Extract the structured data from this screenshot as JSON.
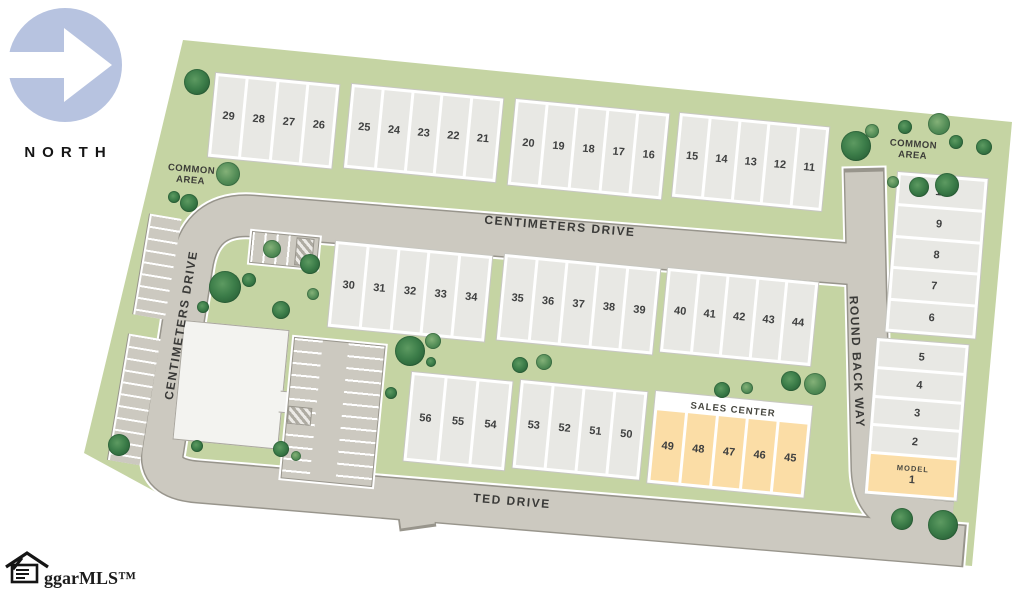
{
  "north_label": "NORTH",
  "logo_text": "ggarMLS™",
  "labels": {
    "common_area_left": "COMMON AREA",
    "common_area_right": "COMMON AREA",
    "sales_center": "SALES CENTER",
    "model": "MODEL"
  },
  "streets": {
    "centimeters_drive_horizontal": "CENTIMETERS DRIVE",
    "centimeters_drive_vertical": "CENTIMETERS DRIVE",
    "round_back_way": "ROUND BACK WAY",
    "ted_drive": "TED DRIVE"
  },
  "lots": {
    "row_top": [
      [
        "29",
        "28",
        "27",
        "26"
      ],
      [
        "25",
        "24",
        "23",
        "22",
        "21"
      ],
      [
        "20",
        "19",
        "18",
        "17",
        "16"
      ],
      [
        "15",
        "14",
        "13",
        "12",
        "11"
      ]
    ],
    "row_mid": [
      [
        "30",
        "31",
        "32",
        "33",
        "34"
      ],
      [
        "35",
        "36",
        "37",
        "38",
        "39"
      ],
      [
        "40",
        "41",
        "42",
        "43",
        "44"
      ]
    ],
    "row_bottom": [
      [
        "56",
        "55",
        "54"
      ],
      [
        "53",
        "52",
        "51",
        "50"
      ]
    ],
    "sales_center_row": [
      "49",
      "48",
      "47",
      "46",
      "45"
    ],
    "right_upper": [
      "10",
      "9",
      "8",
      "7",
      "6"
    ],
    "right_lower": [
      "5",
      "4",
      "3",
      "2"
    ],
    "model_lot": "1"
  },
  "colors": {
    "site_green": "#c5d4a3",
    "road_fill": "#ccc9c0",
    "road_edge": "#98958c",
    "lot_fill": "#e8e8e4",
    "highlight_orange": "#fbdda6",
    "tree_green": "#3c7d49",
    "north_arrow_blue": "#b7c3e0"
  }
}
